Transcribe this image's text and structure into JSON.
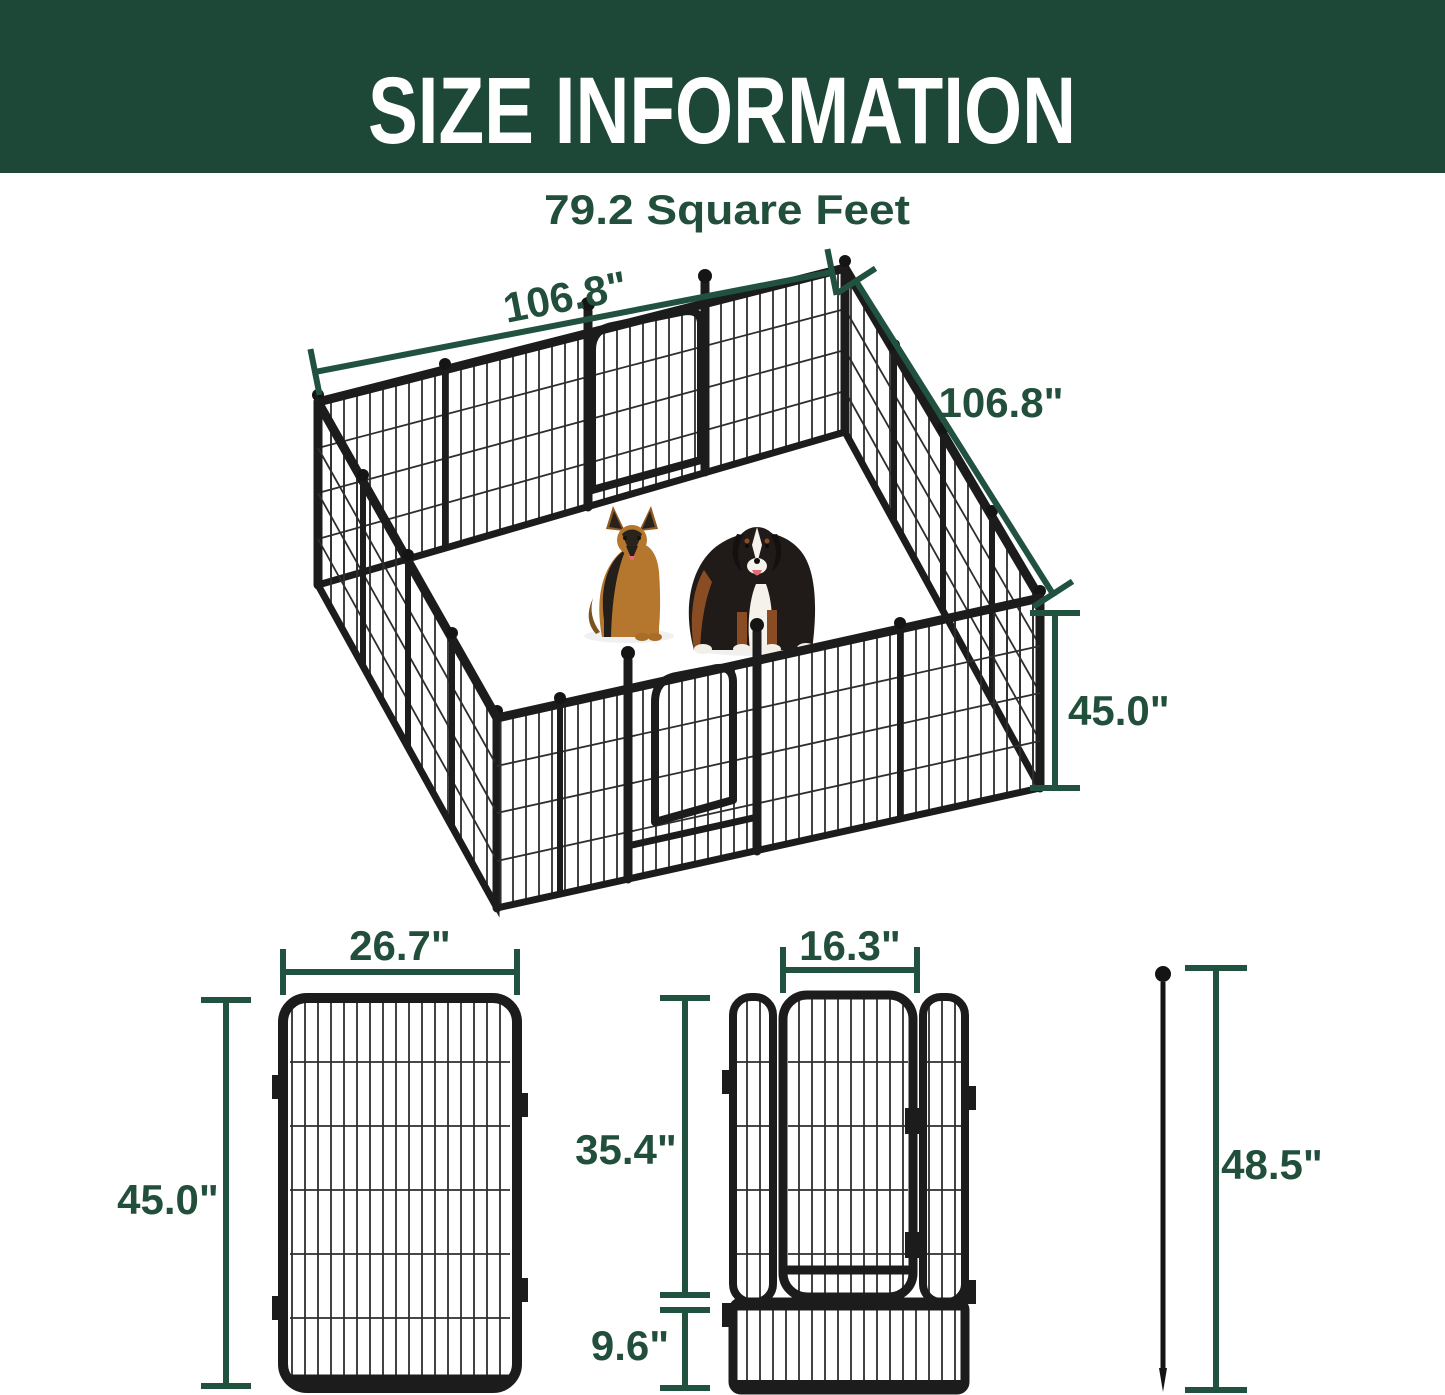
{
  "colors": {
    "banner_green": "#1d4736",
    "dim_line_green": "#215240",
    "dim_text_green": "#224f3c",
    "fence_black": "#1c1c1c",
    "dog_tan": "#b5772e",
    "dog_rust": "#8a4c22"
  },
  "header": {
    "title": "SIZE INFORMATION"
  },
  "area_label": "79.2 Square Feet",
  "pen_diagram": {
    "width_label": "106.8\"",
    "depth_label": "106.8\"",
    "height_label": "45.0\"",
    "dog_icons": [
      "german-shepherd-dog",
      "bernese-mountain-dog"
    ]
  },
  "panel_diagram": {
    "width_label": "26.7\"",
    "height_label": "45.0\""
  },
  "door_diagram": {
    "width_label": "16.3\"",
    "upper_height_label": "35.4\"",
    "lower_height_label": "9.6\""
  },
  "stake_diagram": {
    "height_label": "48.5\""
  }
}
